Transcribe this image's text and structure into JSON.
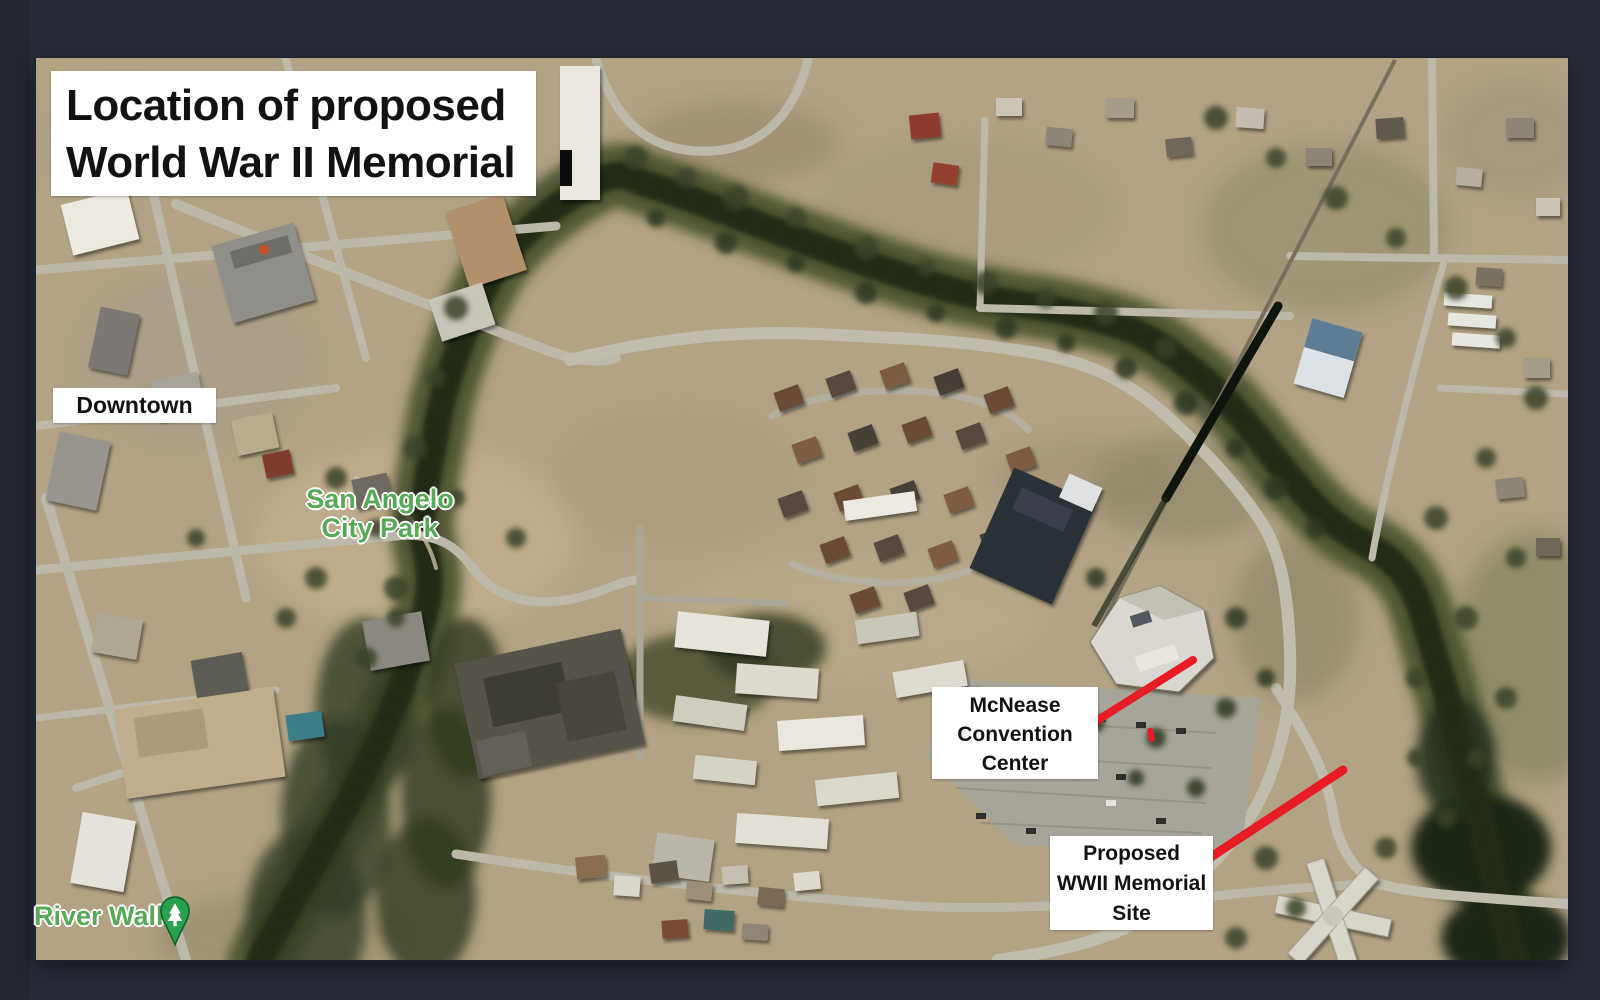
{
  "window": {
    "background": "#272b36",
    "map_edge_color": "#171a21"
  },
  "map": {
    "kind": "satellite-aerial",
    "title": {
      "line1": "Location of proposed",
      "line2": "World War II Memorial"
    },
    "place_labels": {
      "downtown": "Downtown",
      "city_park_line1": "San Angelo",
      "city_park_line2": "City Park",
      "river_walk": "River Walk"
    },
    "callouts": {
      "convention": {
        "line1": "McNease",
        "line2": "Convention",
        "line3": "Center"
      },
      "memorial": {
        "line1": "Proposed",
        "line2": "WWII Memorial",
        "line3": "Site"
      }
    },
    "colors": {
      "annotation_red": "#e81c24",
      "poi_text_green": "#57a857",
      "pin_green": "#2aa14e",
      "water": "#222c19",
      "terrain_tan": "#b2a385",
      "road_gray": "#bcb9ab",
      "label_box": "#ffffff"
    }
  }
}
